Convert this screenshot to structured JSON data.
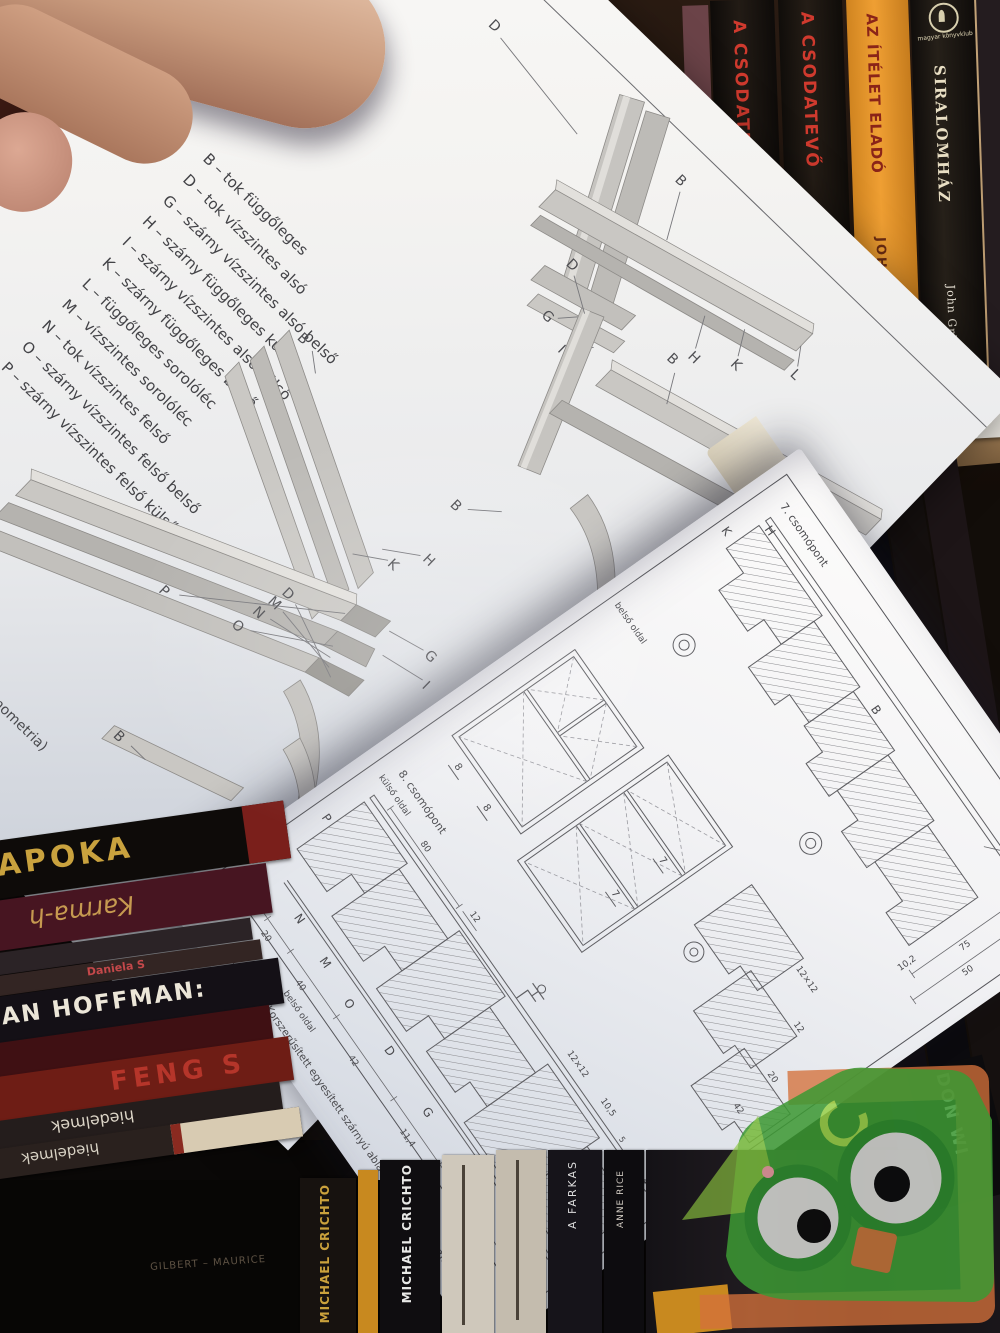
{
  "photo": {
    "subject": "hand holding an open Hungarian joinery textbook above bookshelf",
    "colors": {
      "paper": "#f5f4f2",
      "paper_shadow": "#ccd1db",
      "drawing_ink": "#55555a",
      "profile_gray": "#c9c7c3",
      "watermark_green": "#44a033",
      "watermark_orange": "#d4713b",
      "shelf_wood": "#c2a077"
    }
  },
  "left_page": {
    "running_head_partial": "RAJZAI",
    "legend": [
      "B – tok függőleges",
      "D – tok vízszintes alsó",
      "G – szárny vízszintes alsó belső",
      "H – szárny függőleges külső",
      "I – szárny vízszintes alsó külső",
      "K – szárny függőleges belső",
      "L – függőleges sorolóléc",
      "M – vízszintes sorolóléc",
      "N – tok vízszintes felső",
      "O – szárny vízszintes felső belső",
      "P – szárny vízszintes felső külső"
    ],
    "caption_partial": "…ú ablak sorolóléccel (axonometria)",
    "callouts_a": [
      "D",
      "B",
      "L",
      "K",
      "H",
      "G",
      "I"
    ],
    "callouts_b": [
      "B",
      "H",
      "K",
      "G",
      "I",
      "P",
      "O",
      "N",
      "M",
      "D",
      "B"
    ],
    "callouts_c": [
      "D",
      "B",
      "B"
    ]
  },
  "right_page": {
    "chapter_header": "2. FEJEZET",
    "node_label_7": "7. csomópont",
    "node_label_8": "8. csomópont",
    "outer_side": "külső oldal",
    "inner_side": "belső oldal",
    "caption": "2.47. ábra. Korszerűsített egyesített szárnyú ablak sorolóléccel (csomópontok)",
    "page_number": "67",
    "profiles_upper": [
      "H",
      "K",
      "B"
    ],
    "profiles_lower": [
      "P",
      "N",
      "M",
      "O",
      "D",
      "G"
    ],
    "elevation_marks": [
      "8",
      "8",
      "7",
      "7"
    ],
    "dims_upper": [
      "12",
      "75",
      "50",
      "10,2"
    ],
    "dims_mid": [
      "12×12",
      "12",
      "20",
      "42"
    ],
    "dims_lower_top": [
      "80",
      "12",
      "12×12",
      "10,5",
      "5",
      "9",
      "28"
    ],
    "dims_lower_bottom": [
      "6(4)",
      "20",
      "40",
      "42",
      "11,4",
      "65"
    ]
  },
  "bookshelf": {
    "shelf_label": {
      "letter": "B",
      "text": "20 szek"
    },
    "top_shelf_books": [
      {
        "title": "A CSODATEVŐ",
        "author": "JOHN GRISHAM"
      },
      {
        "title": "A CSODATEVŐ",
        "author": "JOHN GRISHAM"
      },
      {
        "title": "AZ ÍTÉLET ELADÓ",
        "author": "JOHN GRISHAM",
        "publisher": "magyar könyvklub"
      },
      {
        "title": "SIRALOMHÁZ",
        "author": "John Grisham",
        "publisher": "magyar könyvklub"
      }
    ],
    "side_stack_books": [
      {
        "title": "CAT PATRICK"
      },
      {
        "title": "pokol"
      }
    ],
    "left_stack_books": [
      "APOKA",
      "Karma-h",
      "Daniela S",
      "AN HOFFMAN:",
      "FENG S",
      "hiedelmek",
      "hiedelmek"
    ],
    "bottom_row_books": [
      "MICHAEL CRICHTO",
      "MICHAEL CRICHTO",
      "A FARKAS",
      "ANNE RICE",
      "DON WI",
      "GILBERT – MAURICE"
    ]
  }
}
